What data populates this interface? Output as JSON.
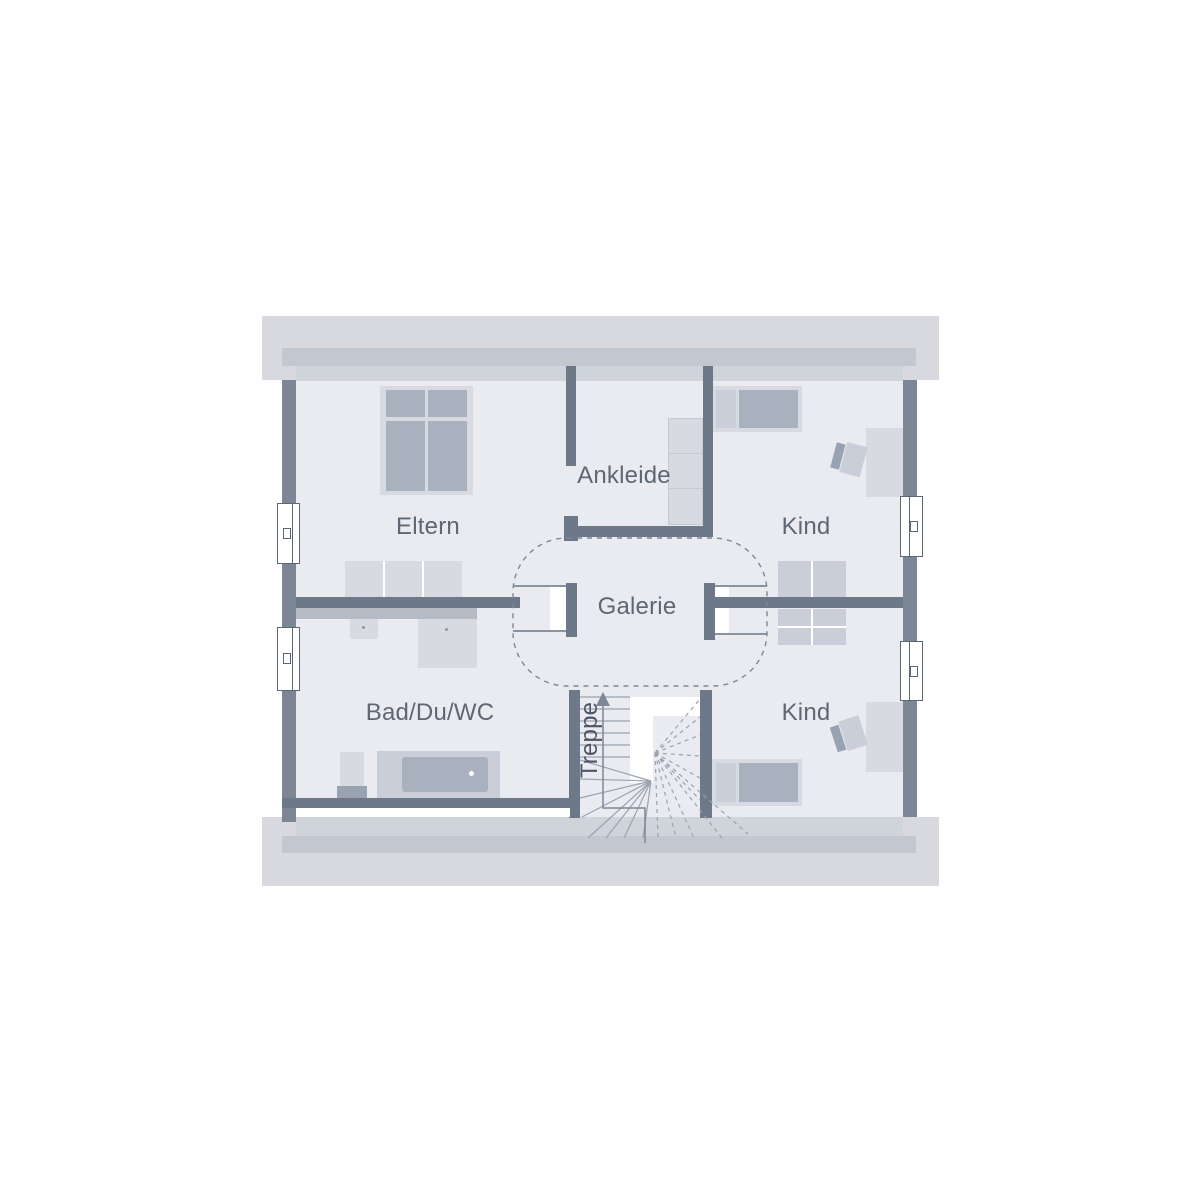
{
  "rooms": [
    {
      "id": "eltern",
      "label": "Eltern"
    },
    {
      "id": "ankleide",
      "label": "Ankleide"
    },
    {
      "id": "kind-top",
      "label": "Kind"
    },
    {
      "id": "galerie",
      "label": "Galerie"
    },
    {
      "id": "bad",
      "label": "Bad/Du/WC"
    },
    {
      "id": "kind-bottom",
      "label": "Kind"
    },
    {
      "id": "treppe",
      "label": "Treppe"
    }
  ],
  "colors": {
    "room_fill": "#e9ebf0",
    "roof_band": "#d7d9de",
    "knee_band": "#c3c7d0",
    "inner_band": "#cfd3da",
    "wall_exterior": "#7d8695",
    "wall_interior": "#6d7888",
    "furniture_light": "#d7dae1",
    "furniture_mid": "#c9ced8",
    "furniture_dark": "#a9b1bf",
    "furniture_darker": "#99a2b0",
    "counter": "#b5bbc5",
    "stair_line": "#9aa3b0",
    "thin_line": "#8a93a0",
    "dash_line": "#7d8796",
    "window_frame": "#5c6776",
    "label_text": "#5e6773",
    "treppe_text": "#4d5664"
  }
}
